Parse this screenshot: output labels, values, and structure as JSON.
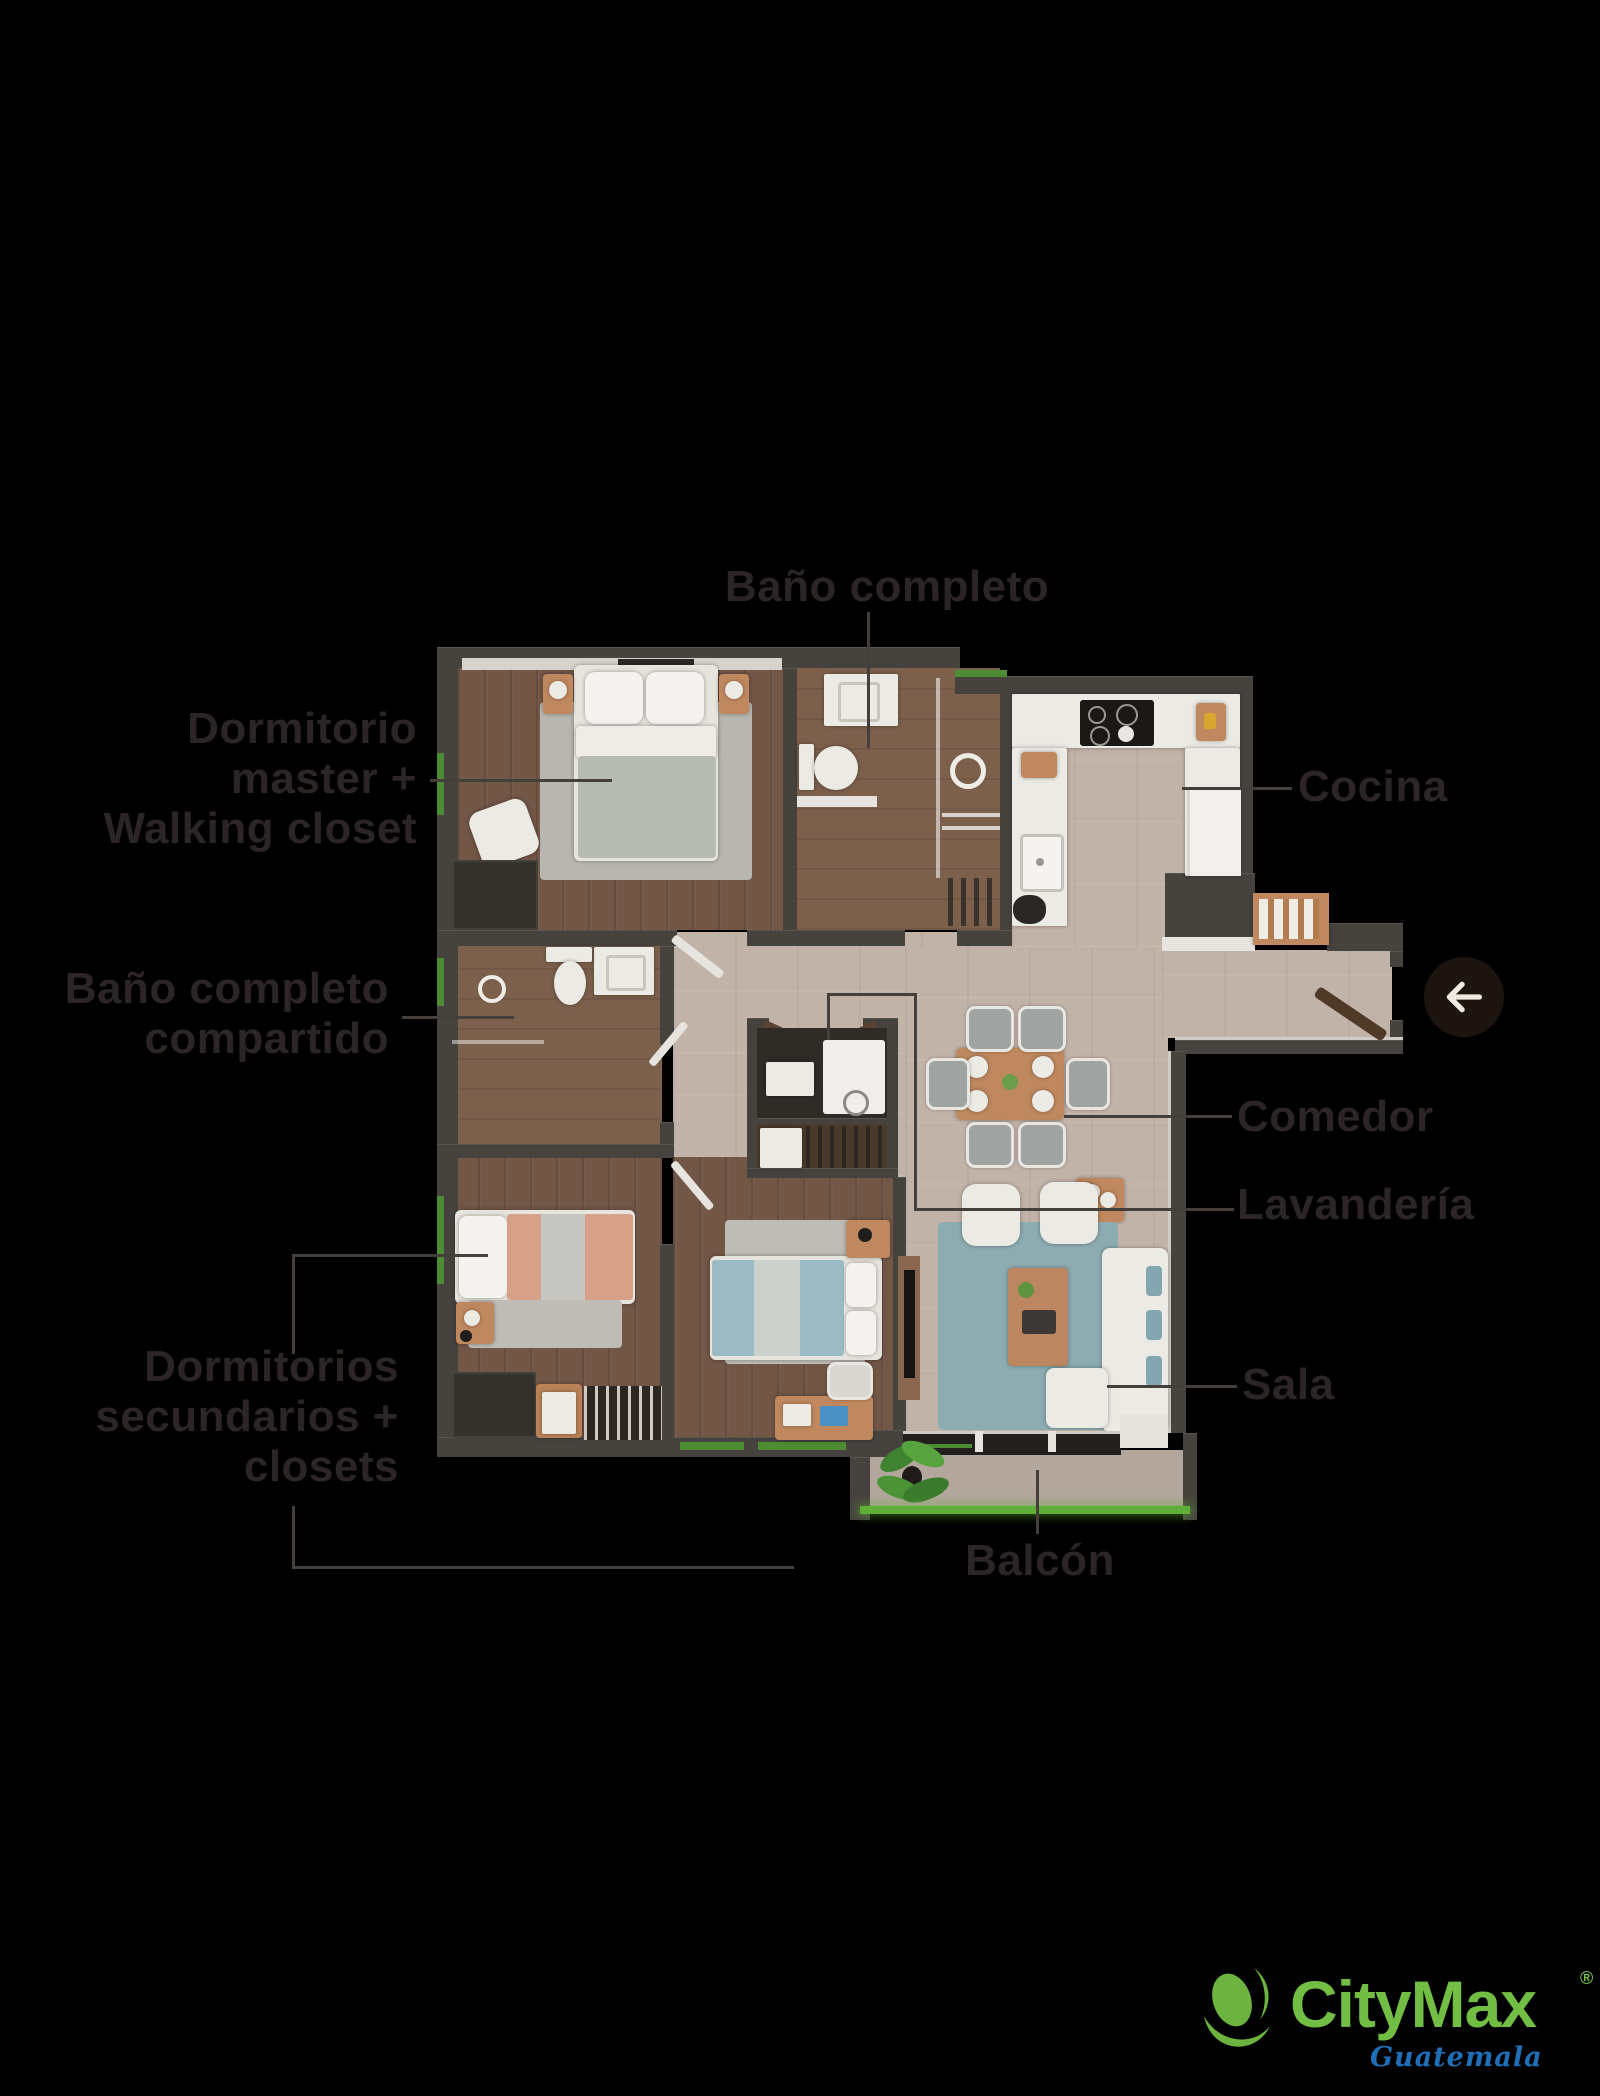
{
  "background_color": "#000000",
  "plan": {
    "labels": {
      "bano_completo": "Baño completo",
      "dormitorio_master": "Dormitorio\nmaster +\nWalking closet",
      "cocina": "Cocina",
      "bano_compartido": "Baño completo\ncompartido",
      "comedor": "Comedor",
      "lavanderia": "Lavandería",
      "dormitorios_secundarios": "Dormitorios\nsecundarios +\nclosets",
      "sala": "Sala",
      "balcon": "Balcón"
    },
    "label_color": "#2b2525",
    "leader_line_color": "#453f3b",
    "rooms": [
      "Dormitorio master + Walking closet",
      "Baño completo",
      "Cocina",
      "Baño completo compartido",
      "Comedor",
      "Lavandería",
      "Sala",
      "Balcón",
      "Dormitorios secundarios + closets"
    ]
  },
  "controls": {
    "back_arrow_icon": "arrow-left"
  },
  "branding": {
    "name": "CityMax",
    "registered_mark": "®",
    "region": "Guatemala",
    "brand_green": "#72BD44",
    "region_blue": "#1F6FB8"
  },
  "palette": {
    "wall": "#46423e",
    "wood_floor": "#725646",
    "tile_floor": "#c2b3a8",
    "bath_floor": "#7c604c",
    "rug_blue": "#8cacb2",
    "bed_pink": "#d7a189",
    "bed_teal": "#9bbac4",
    "furniture_wood": "#c0885f",
    "window_green": "#5fae35"
  }
}
